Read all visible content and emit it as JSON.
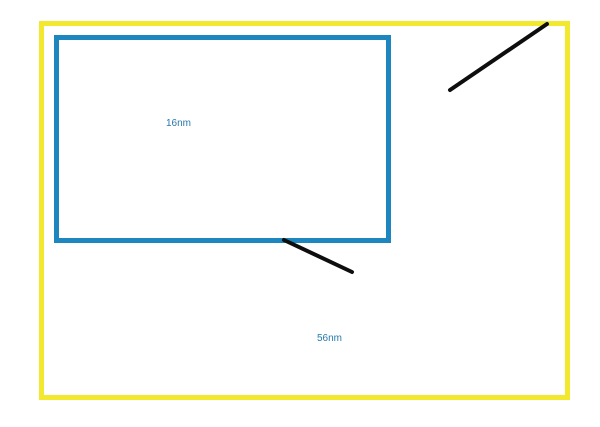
{
  "drawing": {
    "inner_rect_label": "16nm",
    "outer_rect_label": "56nm",
    "colors": {
      "background": "#ffffff",
      "outer_rect_stroke": "#f2e82e",
      "inner_rect_stroke": "#1e86be",
      "line_stroke": "#0e0e0e",
      "label_text": "#2878ac"
    }
  }
}
